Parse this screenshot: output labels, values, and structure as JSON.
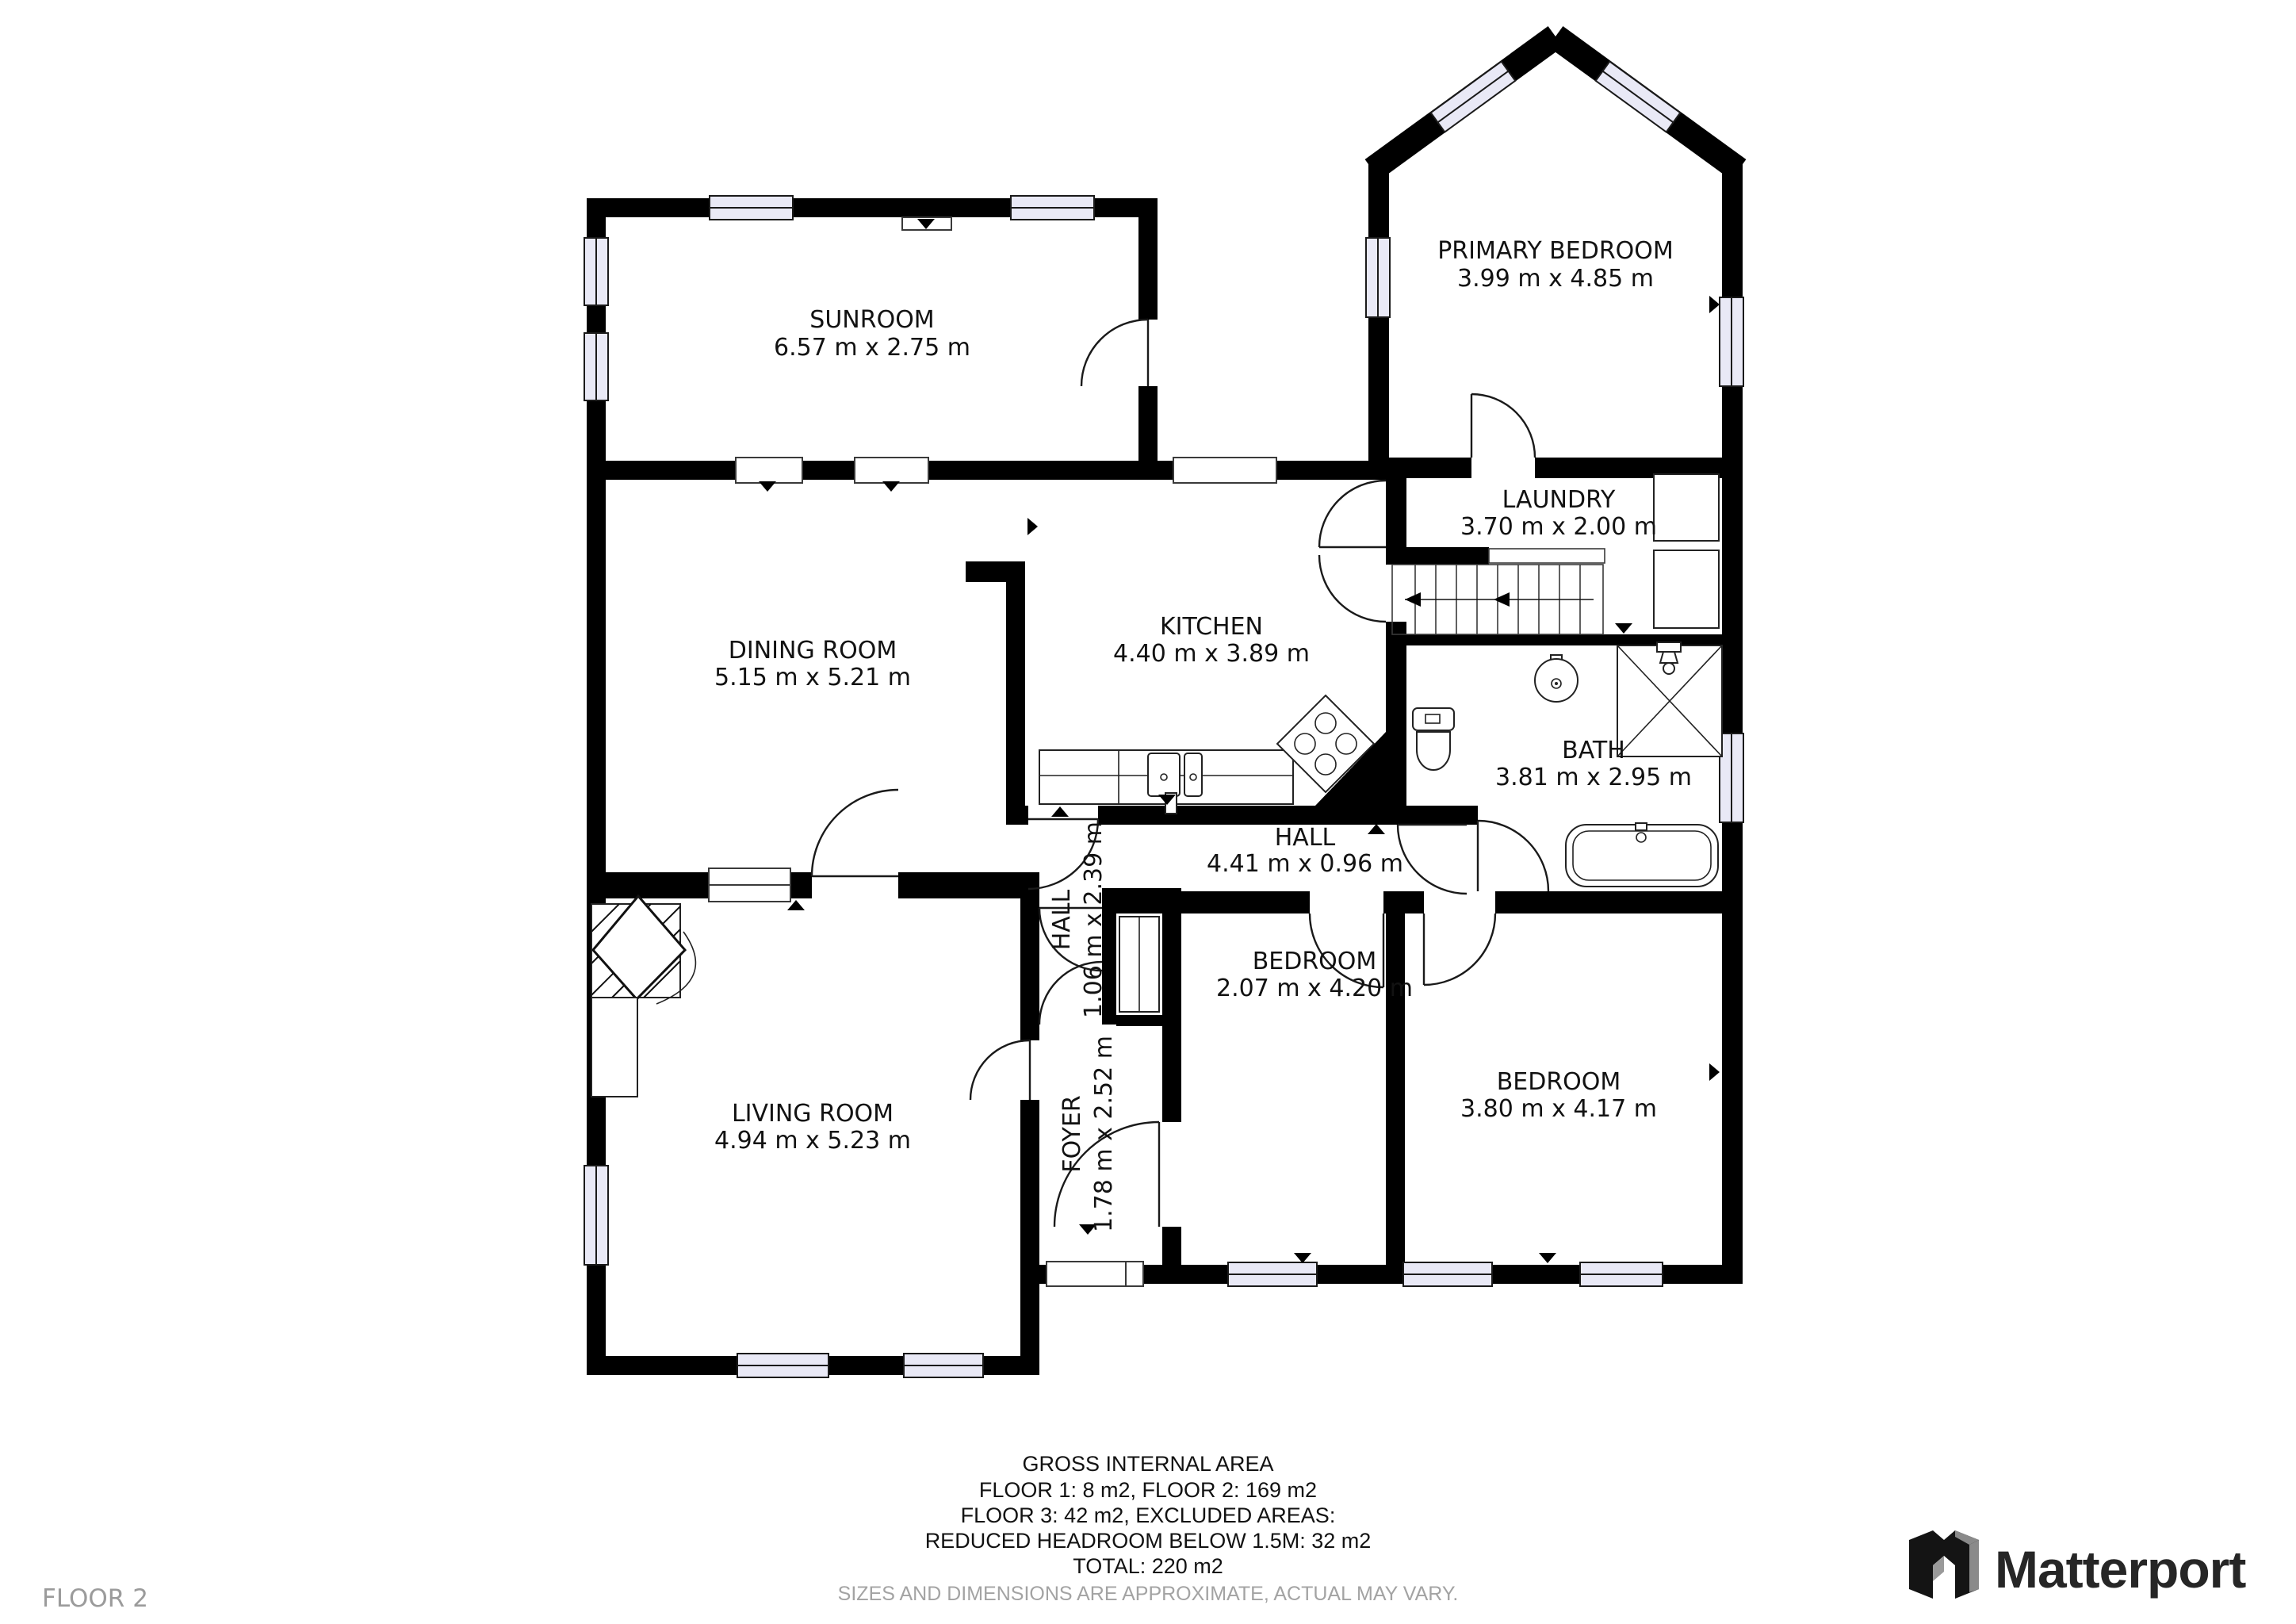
{
  "page": {
    "background": "#ffffff"
  },
  "colors": {
    "wall": "#000000",
    "window_fill": "#e9e9f6",
    "label": "#121212",
    "muted": "#9b9b9b",
    "logo": "#262626"
  },
  "floor_label": "FLOOR 2",
  "rooms": [
    {
      "id": "sunroom",
      "name": "SUNROOM",
      "dims": "6.57 m x 2.75 m"
    },
    {
      "id": "primary-bedroom",
      "name": "PRIMARY BEDROOM",
      "dims": "3.99 m x 4.85 m"
    },
    {
      "id": "laundry",
      "name": "LAUNDRY",
      "dims": "3.70 m x 2.00 m"
    },
    {
      "id": "dining-room",
      "name": "DINING ROOM",
      "dims": "5.15 m x 5.21 m"
    },
    {
      "id": "kitchen",
      "name": "KITCHEN",
      "dims": "4.40 m x 3.89 m"
    },
    {
      "id": "bath",
      "name": "BATH",
      "dims": "3.81 m x 2.95 m"
    },
    {
      "id": "hall",
      "name": "HALL",
      "dims": "4.41 m x 0.96 m"
    },
    {
      "id": "hall-vertical",
      "name": "HALL",
      "dims": "1.06 m x 2.39 m"
    },
    {
      "id": "bedroom-small",
      "name": "BEDROOM",
      "dims": "2.07 m x 4.20 m"
    },
    {
      "id": "bedroom-large",
      "name": "BEDROOM",
      "dims": "3.80 m x 4.17 m"
    },
    {
      "id": "living-room",
      "name": "LIVING ROOM",
      "dims": "4.94 m x 5.23 m"
    },
    {
      "id": "foyer",
      "name": "FOYER",
      "dims": "1.78 m x 2.52 m"
    }
  ],
  "footer": {
    "line1": "GROSS INTERNAL AREA",
    "line2": "FLOOR 1: 8 m2, FLOOR 2: 169 m2",
    "line3": "FLOOR 3: 42 m2, EXCLUDED AREAS:",
    "line4": "REDUCED HEADROOM BELOW 1.5M: 32 m2",
    "line5": "TOTAL: 220 m2",
    "disclaimer": "SIZES AND DIMENSIONS ARE APPROXIMATE, ACTUAL MAY VARY."
  },
  "brand": {
    "name": "Matterport"
  }
}
